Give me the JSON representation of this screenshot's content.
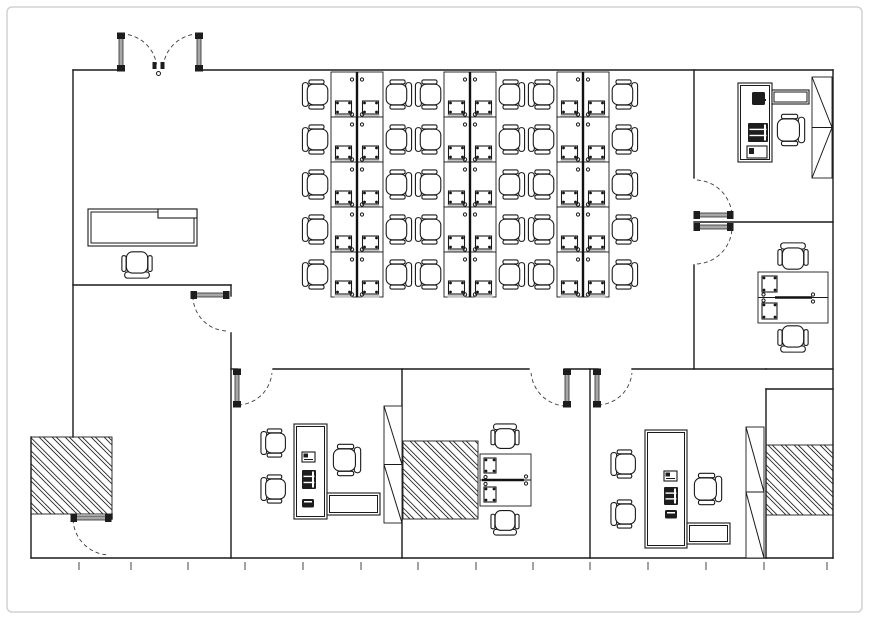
{
  "plan": {
    "canvas": {
      "w": 869,
      "h": 619,
      "frame": {
        "x": 7,
        "y": 7,
        "w": 855,
        "h": 605,
        "r": 5
      }
    },
    "colors": {
      "wall": "#1a1a1a",
      "door_leaf": "#a8a8a8",
      "door_cap": "#1d1d1d",
      "arc_dash": "#3a3a3a",
      "gray_accent": "#c4c4c4",
      "frame": "#d2d2d2"
    },
    "walls": [
      [
        73,
        70,
        120,
        70
      ],
      [
        199,
        70,
        833,
        70
      ],
      [
        73,
        70,
        73,
        437
      ],
      [
        31,
        437,
        31,
        558
      ],
      [
        31,
        558,
        833,
        558
      ],
      [
        833,
        70,
        833,
        558
      ],
      [
        73,
        285,
        231,
        285
      ],
      [
        231,
        285,
        231,
        296
      ],
      [
        231,
        333,
        231,
        558
      ],
      [
        231,
        369,
        237,
        369
      ],
      [
        273,
        369,
        529,
        369
      ],
      [
        565,
        369,
        598,
        369
      ],
      [
        632,
        369,
        766,
        369
      ],
      [
        766,
        369,
        833,
        369
      ],
      [
        766,
        389,
        833,
        389
      ],
      [
        766,
        389,
        766,
        558
      ],
      [
        402,
        369,
        402,
        558
      ],
      [
        590,
        369,
        590,
        558
      ],
      [
        694,
        70,
        694,
        178
      ],
      [
        694,
        265,
        694,
        369
      ],
      [
        694,
        222,
        833,
        222
      ],
      [
        112,
        514,
        112,
        519
      ]
    ],
    "doors": [
      {
        "name": "entry-door-left",
        "leaf": [
          119,
          34,
          4,
          36
        ],
        "arc": [
          121,
          70,
          36,
          270,
          351
        ]
      },
      {
        "name": "entry-door-right",
        "leaf": [
          197,
          34,
          4,
          36
        ],
        "arc": [
          199,
          70,
          36,
          270,
          189
        ]
      },
      {
        "name": "reception-door",
        "leaf": [
          192,
          293,
          36,
          4
        ],
        "arc": [
          228,
          296,
          35,
          180,
          92
        ]
      },
      {
        "name": "office-ne-door",
        "leaf": [
          695,
          213,
          37,
          4
        ],
        "arc": [
          695,
          217,
          37,
          355,
          272
        ]
      },
      {
        "name": "office-mid-east-door",
        "leaf": [
          695,
          225,
          37,
          4
        ],
        "arc": [
          695,
          227,
          37,
          5,
          88
        ]
      },
      {
        "name": "office-a-door",
        "leaf": [
          235,
          370,
          4,
          36
        ],
        "arc": [
          237,
          370,
          35,
          88,
          5
        ]
      },
      {
        "name": "office-b-door",
        "leaf": [
          565,
          370,
          4,
          36
        ],
        "arc": [
          567,
          370,
          36,
          92,
          175
        ]
      },
      {
        "name": "office-c-door",
        "leaf": [
          595,
          370,
          4,
          36
        ],
        "arc": [
          597,
          370,
          35,
          88,
          5
        ]
      },
      {
        "name": "sw-closet-door",
        "leaf": [
          72,
          516,
          38,
          4
        ],
        "arc": [
          110,
          518,
          37,
          178,
          95
        ]
      }
    ],
    "entry_marks": {
      "rects": [
        [
          152.5,
          62,
          4,
          7
        ],
        [
          160.5,
          62,
          4,
          7
        ]
      ],
      "circle": [
        158.5,
        73.5,
        2
      ]
    },
    "hatched_areas": [
      {
        "name": "hatched-area-southwest",
        "rect": [
          31,
          437,
          81,
          77
        ]
      },
      {
        "name": "hatched-area-south-center",
        "rect": [
          403,
          441,
          75,
          78
        ]
      },
      {
        "name": "hatched-area-southeast",
        "rect": [
          766,
          445,
          67,
          70
        ]
      }
    ],
    "cabinets": [
      {
        "name": "cabinet-office-ne",
        "rect": [
          812,
          77,
          20,
          101
        ],
        "div": 127.5,
        "diag": [
          "\\",
          "/"
        ]
      },
      {
        "name": "cabinet-office-a",
        "rect": [
          384,
          406,
          18,
          117
        ],
        "div": 464.5,
        "diag": [
          "\\",
          "\\"
        ]
      },
      {
        "name": "cabinet-office-c",
        "rect": [
          746,
          427,
          18,
          131
        ],
        "div": 492,
        "diag": [
          "\\",
          "\\"
        ]
      }
    ],
    "workstation_banks": {
      "xs": [
        331,
        444,
        557
      ],
      "top": 72,
      "row_h": 45,
      "rows": 5,
      "desk_w": 26,
      "chair_size": 27,
      "chair_gap": 14
    },
    "double_desks": [
      {
        "name": "shared-desk-mid-east",
        "desk": [
          758,
          272,
          70,
          51
        ],
        "div_y": 297.5,
        "thick": [
          775,
          812
        ],
        "computers": [
          [
            762,
            276,
            15,
            16
          ],
          [
            762,
            303,
            15,
            16
          ]
        ],
        "comp_circles": [
          [
            763.5,
            294.5
          ],
          [
            763.5,
            300.5
          ]
        ],
        "end_circles": [
          [
            813,
            294.5
          ],
          [
            813,
            301.5
          ]
        ],
        "chairs": [
          [
            793,
            258,
            "down",
            28
          ],
          [
            793,
            337,
            "up",
            28
          ]
        ]
      },
      {
        "name": "shared-desk-office-b",
        "desk": [
          480,
          454,
          51,
          52
        ],
        "div_y": 480,
        "thick": [
          482,
          524
        ],
        "computers": [
          [
            484,
            458,
            12,
            15
          ],
          [
            484,
            487,
            12,
            15
          ]
        ],
        "comp_circles": [
          [
            485.5,
            477
          ],
          [
            485.5,
            484
          ]
        ],
        "end_circles": [
          [
            526,
            476.5
          ],
          [
            526,
            483.5
          ]
        ],
        "chairs": [
          [
            505,
            438,
            "down",
            26
          ],
          [
            505,
            521,
            "up",
            26
          ]
        ]
      }
    ],
    "executive_sets": [
      {
        "name": "executive-office-a",
        "desk": [
          294,
          424,
          33,
          95
        ],
        "inset": 2.5,
        "folder": [
          302,
          452
        ],
        "computer": [
          302,
          470,
          14,
          19
        ],
        "phone": [
          302,
          499
        ],
        "guest_chairs": [
          [
            275,
            443
          ],
          [
            275,
            489
          ]
        ],
        "task_chair": [
          345,
          460,
          "left",
          29
        ],
        "side_table": [
          327,
          493,
          53,
          22
        ]
      },
      {
        "name": "executive-office-c",
        "desk": [
          645,
          430,
          42,
          118
        ],
        "inset": 2.5,
        "folder": [
          664,
          471
        ],
        "computer": [
          664,
          487,
          14,
          18
        ],
        "phone": [
          665,
          510
        ],
        "guest_chairs": [
          [
            625,
            464
          ],
          [
            625,
            514
          ]
        ],
        "task_chair": [
          706,
          489,
          "left",
          29
        ],
        "side_table": [
          687,
          523,
          43,
          21
        ]
      }
    ],
    "corner_office": {
      "name": "office-ne",
      "desk": [
        738,
        83,
        34,
        79
      ],
      "inset": 2.5,
      "phone": [
        752,
        92,
        13,
        13
      ],
      "computer": [
        748,
        123,
        20,
        19
      ],
      "box": [
        747,
        146,
        20,
        12
      ],
      "return_shelf": [
        772,
        90,
        37,
        14
      ],
      "chair": [
        789,
        130,
        "left",
        29
      ]
    },
    "reception": {
      "desk": [
        88,
        209,
        109,
        37
      ],
      "inset": 3,
      "shelf": [
        158,
        209,
        39,
        9
      ],
      "chair": [
        137,
        263,
        "up",
        28
      ]
    },
    "ruler_ticks": {
      "y1": 562,
      "y2": 570,
      "xs": [
        79,
        131,
        188,
        245,
        303,
        361,
        418,
        476,
        533,
        590,
        648,
        706,
        764,
        827
      ]
    }
  }
}
